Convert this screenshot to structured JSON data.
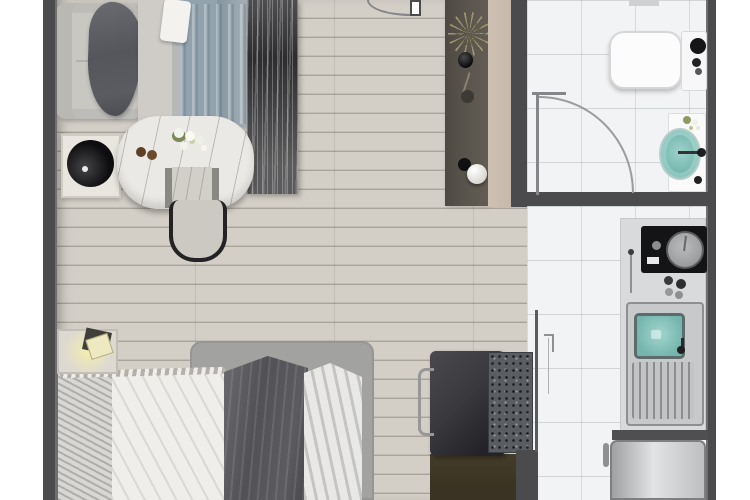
{
  "scene": {
    "type": "apartment-floor-plan-rendering",
    "view": "top-down",
    "rooms": [
      {
        "name": "living-dining-area",
        "furniture": [
          "sofa",
          "throw-blanket",
          "round-black-side-table",
          "wardrobe-with-drape",
          "abstract-art-panel",
          "marble-dining-table",
          "flower-centerpiece",
          "wooden-plates",
          "dining-chair"
        ]
      },
      {
        "name": "sleeping-area",
        "furniture": [
          "bed-platform",
          "pillows",
          "white-sheet",
          "dark-duvet",
          "white-duvet",
          "headboard",
          "nightstand-with-lamp"
        ]
      },
      {
        "name": "entry-hall",
        "furniture": [
          "entry-door",
          "console-panel",
          "palm-plant",
          "black-vase",
          "decor-branch",
          "decor-spheres"
        ]
      },
      {
        "name": "bathroom",
        "furniture": [
          "toilet",
          "cistern",
          "vanity",
          "teal-basin",
          "faucet",
          "bathroom-door"
        ]
      },
      {
        "name": "kitchen",
        "furniture": [
          "cooktop",
          "burner",
          "control-knobs",
          "sink-unit",
          "teal-sink",
          "drainboard",
          "fridge"
        ]
      },
      {
        "name": "desk-nook",
        "furniture": [
          "desk",
          "desk-chair",
          "stone-slab",
          "dark-rug"
        ]
      }
    ]
  },
  "colors": {
    "wall": "#4b4b4d",
    "wall_light": "#6f6f71",
    "wood": "#ccc8c0",
    "wood_plank": "#d3cfc7",
    "wood_line": "#a9a39a",
    "tile": "#f2f3f5",
    "beige": "#c6b8ab",
    "console": "#57534b",
    "art": "#2d2d2f",
    "drape": "#92a3ae",
    "panel_light": "#cfccc8",
    "sofa": "#c8c7c2",
    "throw": "#55565b",
    "marble": "#ebe9e5",
    "flower_green": "#7c8a58",
    "flower_white": "#f4f4ee",
    "plate": "#5e4026",
    "chair_dark": "#232325",
    "chair_seat": "#d2cfc8",
    "ball": "#0d0d0f",
    "table_white": "#e9e6e0",
    "glow": "#efe9c2",
    "lamp_dark": "#3f3e3a",
    "headboard": "#7b7b7e",
    "platform": "#a2a2a0",
    "pillow": "#d9d7d3",
    "sheet": "#efeeea",
    "duvet": "#515156",
    "duvet_white": "#e9e8e6",
    "desk": "#3a3a3e",
    "desk_rug": "#3a3323",
    "slab": "#5a5e63",
    "chairc": "#97979a",
    "counter": "#d9dadc",
    "cooktop": "#141416",
    "burner": "#9fa1a3",
    "sink_unit": "#c8c9cb",
    "teal": "#74b5ad",
    "teal_light": "#a8d8d2",
    "drain": "#8c8d8f",
    "steel_a": "#9fa1a3",
    "steel_b": "#e2e3e5",
    "door": "#85868a",
    "black": "#151517"
  }
}
